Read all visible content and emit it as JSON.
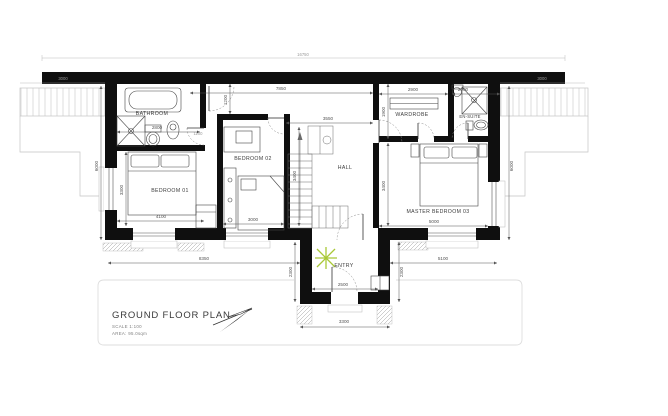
{
  "title_block": {
    "title": "GROUND FLOOR PLAN",
    "scale": "SCALE 1:100",
    "area": "AREA: 95.0sqm"
  },
  "rooms": {
    "bathroom": "BATHROOM",
    "bedroom01": "BEDROOM 01",
    "bedroom02": "BEDROOM 02",
    "hall": "HALL",
    "wardrobe": "WARDROBE",
    "ensuite": "EN-SUITE",
    "master_bedroom": "MASTER BEDROOM 03",
    "entry": "ENTRY"
  },
  "dimensions_mm": {
    "overall_width": "16750",
    "left_wing_width": "7850",
    "porch_recess": "1200",
    "bathroom_width": "2800",
    "bathroom_door": "1100",
    "bedroom01_width": "4100",
    "bedroom01_depth": "3300",
    "bedroom02_width": "3000",
    "hall_width": "3550",
    "hall_depth": "3400",
    "wardrobe_width": "2900",
    "wardrobe_depth": "1900",
    "ensuite_width": "2000",
    "master_width": "5000",
    "master_depth": "3400",
    "bottom_left": "8350",
    "bottom_right": "5100",
    "entry_width": "2500",
    "entry_depth_left": "2300",
    "entry_depth_right": "2300",
    "entry_outer_width": "3300",
    "side_wing_depth_left": "6000",
    "side_wing_depth_right": "6000",
    "terrace_left": "3000",
    "terrace_right": "3000"
  },
  "colors": {
    "wall": "#0f0f0f",
    "fixture": "#454545",
    "dimension": "#555555",
    "terrace": "#c4c4c4",
    "faint": "#dedede",
    "plant_accent": "#a9c837"
  }
}
